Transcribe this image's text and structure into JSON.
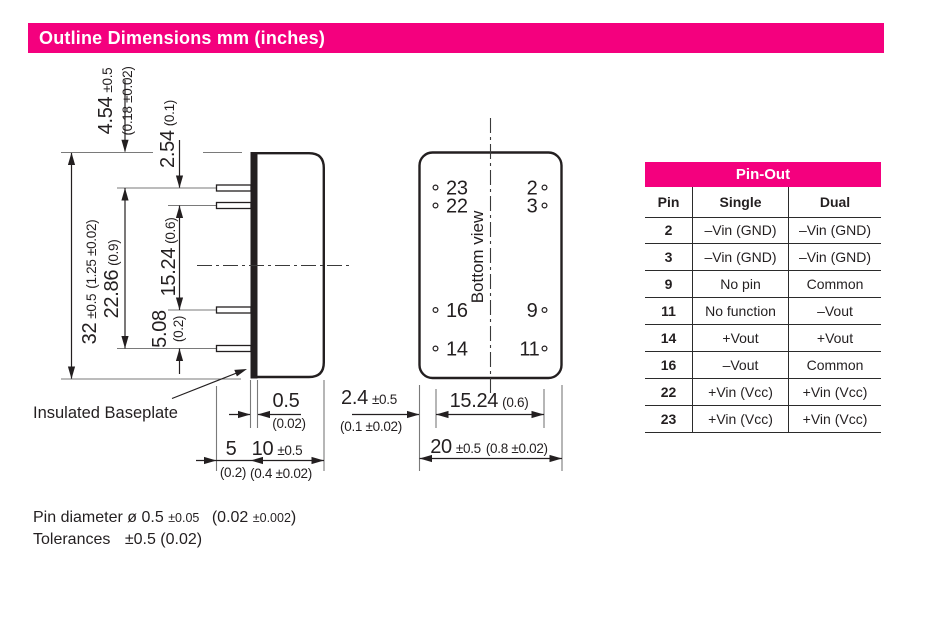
{
  "colors": {
    "accent": "#F4007E",
    "ink": "#231f20"
  },
  "header": {
    "title": "Outline Dimensions mm (inches)"
  },
  "side_view": {
    "baseplate_label": "Insulated Baseplate",
    "d454": {
      "mm": "4.54",
      "tol": "±0.5",
      "inch": "(0.18 ±0.02)"
    },
    "d254": {
      "mm": "2.54",
      "inch": "(0.1)"
    },
    "d32": {
      "mm": "32",
      "tol": "±0.5",
      "inch": "(1.25 ±0.02)"
    },
    "d2286": {
      "mm": "22.86",
      "inch": "(0.9)"
    },
    "d1524": {
      "mm": "15.24",
      "inch": "(0.6)"
    },
    "d508": {
      "mm": "5.08",
      "inch": "(0.2)"
    },
    "d05": {
      "mm": "0.5",
      "inch": "(0.02)"
    },
    "d5": {
      "mm": "5",
      "inch": "(0.2)"
    },
    "d10": {
      "mm": "10",
      "tol": "±0.5",
      "inch": "(0.4 ±0.02)"
    }
  },
  "bottom_view": {
    "label": "Bottom view",
    "pins_left": [
      "23",
      "22",
      "16",
      "14"
    ],
    "pins_right": [
      "2",
      "3",
      "9",
      "11"
    ],
    "d24": {
      "mm": "2.4",
      "tol": "±0.5",
      "inch": "(0.1 ±0.02)"
    },
    "d1524": {
      "mm": "15.24",
      "inch": "(0.6)"
    },
    "d20": {
      "mm": "20",
      "tol": "±0.5",
      "inch": "(0.8 ±0.02)"
    }
  },
  "pinout": {
    "title": "Pin-Out",
    "columns": [
      "Pin",
      "Single",
      "Dual"
    ],
    "rows": [
      {
        "pin": "2",
        "single": "–Vin (GND)",
        "dual": "–Vin (GND)"
      },
      {
        "pin": "3",
        "single": "–Vin (GND)",
        "dual": "–Vin (GND)"
      },
      {
        "pin": "9",
        "single": "No pin",
        "dual": "Common"
      },
      {
        "pin": "11",
        "single": "No function",
        "dual": "–Vout"
      },
      {
        "pin": "14",
        "single": "+Vout",
        "dual": "+Vout"
      },
      {
        "pin": "16",
        "single": "–Vout",
        "dual": "Common"
      },
      {
        "pin": "22",
        "single": "+Vin (Vcc)",
        "dual": "+Vin (Vcc)"
      },
      {
        "pin": "23",
        "single": "+Vin (Vcc)",
        "dual": "+Vin (Vcc)"
      }
    ]
  },
  "notes": {
    "pin_diameter_main": "Pin diameter ø 0.5",
    "pin_diameter_tol": "±0.05",
    "pin_diameter_inch": "(0.02",
    "pin_diameter_inch_tol": "±0.002",
    "pin_diameter_inch_close": ")",
    "tolerances_label": "Tolerances",
    "tolerances_value": "±0.5 (0.02)"
  }
}
